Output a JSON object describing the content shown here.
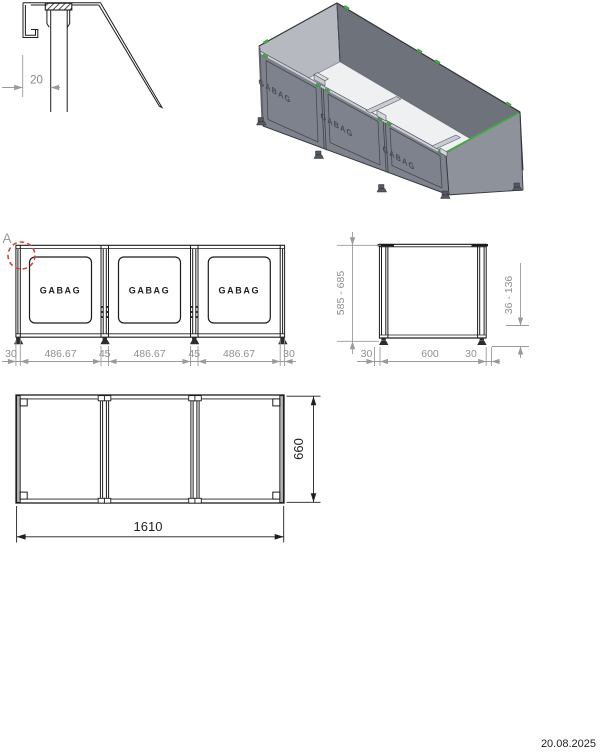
{
  "detail": {
    "width_dim": "20"
  },
  "front": {
    "detail_marker": "A",
    "panel_logos": [
      "GABAG",
      "GABAG",
      "GABAG"
    ],
    "dims": [
      "30",
      "486.67",
      "45",
      "486.67",
      "45",
      "486.67",
      "30"
    ]
  },
  "side": {
    "height_dim": "585 - 685",
    "clearance_dim": "36 - 136",
    "bottom_dims": [
      "30",
      "600",
      "30"
    ]
  },
  "plan": {
    "length_dim": "1610",
    "depth_dim": "660"
  },
  "iso": {
    "panel_logos": [
      "GABAG",
      "GABAG",
      "GABAG"
    ]
  },
  "footer": {
    "date": "20.08.2025"
  },
  "colors": {
    "line": "#1c1c1c",
    "dim_text": "#8f8f8f",
    "plan_dim_text": "#1f1f1f",
    "detail_circle": "#d8413e",
    "clip_green": "#3fae42",
    "panel_gray": "#7e828c",
    "back_wall_gray": "#6e727a",
    "left_wall_light": "#b6b9c0",
    "right_wall_gray": "#8e929b"
  }
}
